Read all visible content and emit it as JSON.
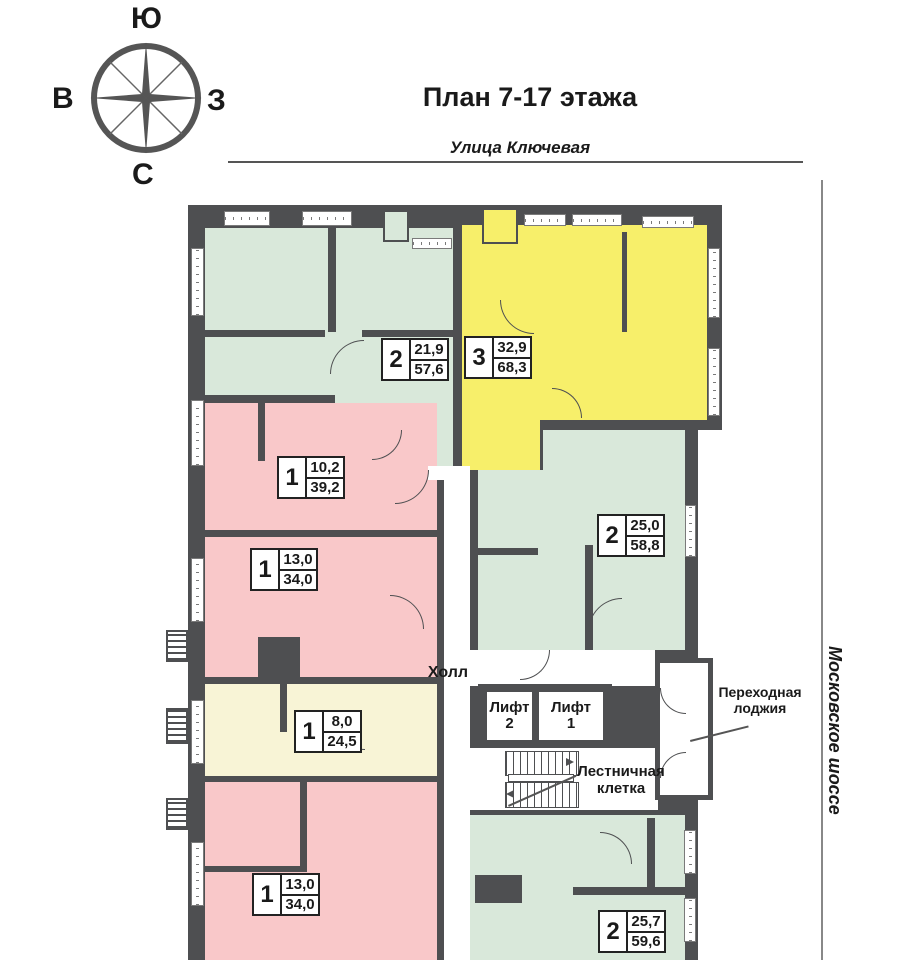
{
  "header": {
    "title": "План 7-17 этажа"
  },
  "compass": {
    "top": "Ю",
    "left": "В",
    "right": "З",
    "bottom": "С"
  },
  "streets": {
    "top": "Улица Ключевая",
    "side": "Московское шоссе"
  },
  "places": {
    "hall": "Холл",
    "lift_word": "Лифт",
    "lift1_num": "1",
    "lift2_num": "2",
    "stairs_line1": "Лестничная",
    "stairs_line2": "клетка",
    "loggia_line1": "Переходная",
    "loggia_line2": "лоджия"
  },
  "apartments": [
    {
      "id": "apt-2room-top",
      "rooms": "2",
      "living_area": "21,9",
      "total_area": "57,6",
      "color": "#d9e8da"
    },
    {
      "id": "apt-3room-top",
      "rooms": "3",
      "living_area": "32,9",
      "total_area": "68,3",
      "color": "#f7ef6a"
    },
    {
      "id": "apt-1room-a",
      "rooms": "1",
      "living_area": "10,2",
      "total_area": "39,2",
      "color": "#f9c8c9"
    },
    {
      "id": "apt-1room-b",
      "rooms": "1",
      "living_area": "13,0",
      "total_area": "34,0",
      "color": "#f9c8c9"
    },
    {
      "id": "apt-2room-mid",
      "rooms": "2",
      "living_area": "25,0",
      "total_area": "58,8",
      "color": "#d9e8da"
    },
    {
      "id": "apt-1room-c",
      "rooms": "1",
      "living_area": "8,0",
      "total_area": "24,5",
      "color": "#f8f4d6"
    },
    {
      "id": "apt-1room-d",
      "rooms": "1",
      "living_area": "13,0",
      "total_area": "34,0",
      "color": "#f9c8c9"
    },
    {
      "id": "apt-2room-bottom",
      "rooms": "2",
      "living_area": "25,7",
      "total_area": "59,6",
      "color": "#d9e8da"
    }
  ],
  "colors": {
    "wall": "#4e4f51",
    "green": "#d9e8da",
    "yellow": "#f7ef6a",
    "pink": "#f9c8c9",
    "cream": "#f8f4d6"
  }
}
